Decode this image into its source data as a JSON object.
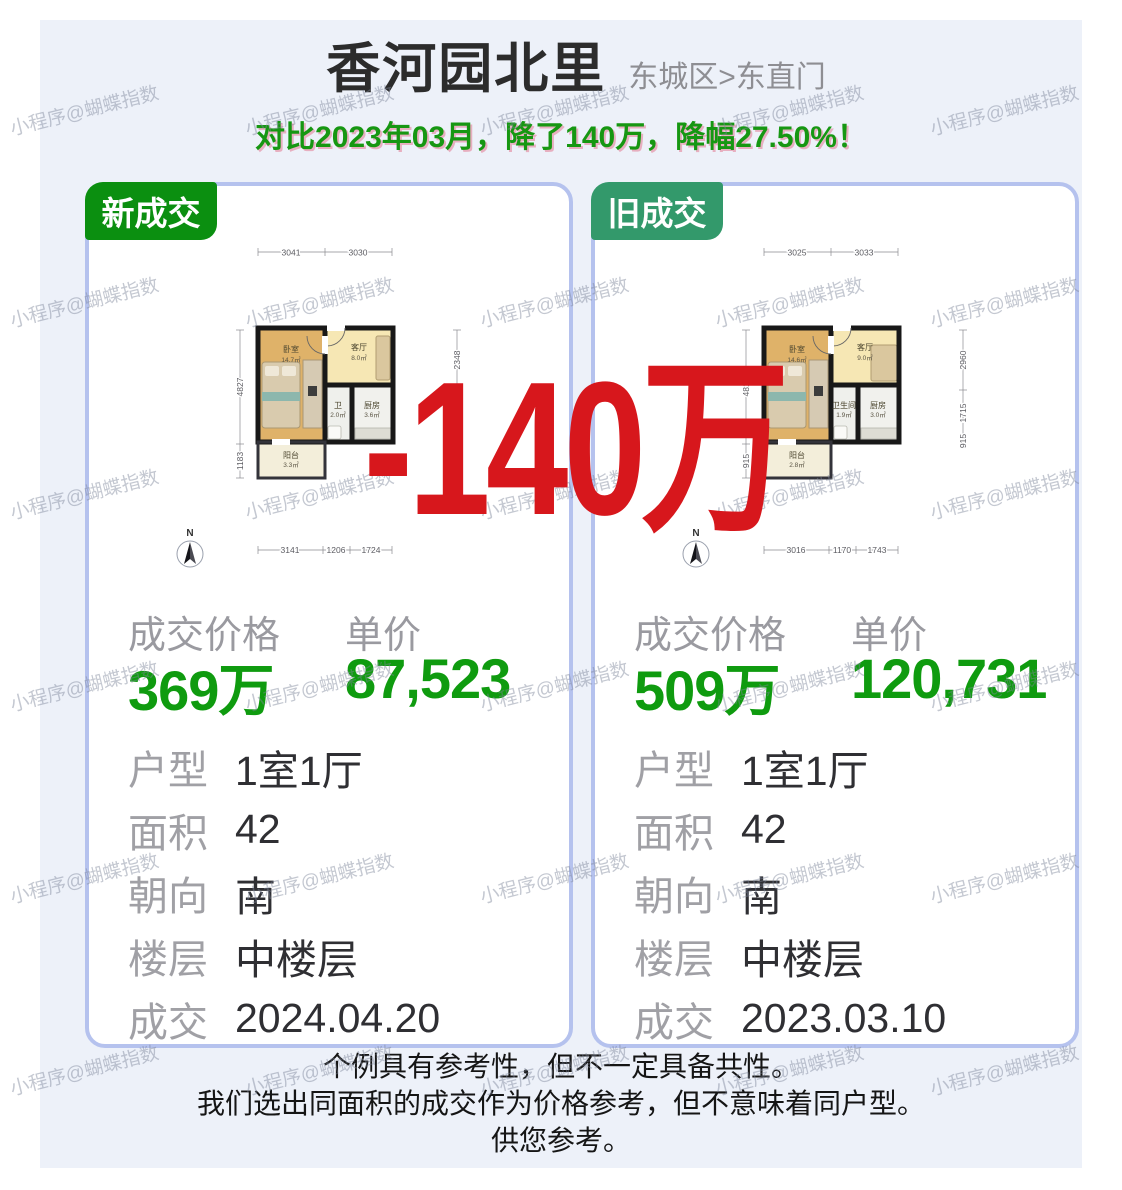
{
  "page": {
    "title": "香河园北里",
    "subtitle": "东城区>东直门",
    "banner": "对比2023年03月，降了140万，降幅27.50%！",
    "drop_text": "-140万",
    "watermark": "小程序@蝴蝶指数",
    "footer_lines": [
      "个例具有参考性，但不一定具备共性。",
      "我们选出同面积的成交作为价格参考，但不意味着同户型。",
      "供您参考。"
    ]
  },
  "colors": {
    "panel_bg": "#edf1f9",
    "card_border": "#b5c2ee",
    "badge_new_green": "#0b8f10",
    "badge_old_green": "#33996b",
    "price_green": "#0f9b0f",
    "banner_green": "#169712",
    "drop_red": "#d7171c"
  },
  "cards": [
    {
      "badge": "新成交",
      "badge_color": "#0b8f10",
      "price_label": "成交价格",
      "unit_label": "单价",
      "price": "369万",
      "unit_price": "87,523",
      "details": [
        {
          "label": "户型",
          "value": "1室1厅"
        },
        {
          "label": "面积",
          "value": "42"
        },
        {
          "label": "朝向",
          "value": "南"
        },
        {
          "label": "楼层",
          "value": "中楼层"
        },
        {
          "label": "成交",
          "value": "2024.04.20"
        }
      ],
      "floorplan": {
        "dims_top": [
          "3041",
          "3030"
        ],
        "dims_left": [
          "4827",
          "1183"
        ],
        "dims_right": [
          "2348",
          "1784",
          "106"
        ],
        "dims_bottom": [
          "3141",
          "1206",
          "1724"
        ],
        "rooms": [
          {
            "name": "卧室",
            "area": "14.7㎡"
          },
          {
            "name": "客厅",
            "area": "8.0㎡"
          },
          {
            "name": "卫",
            "area": "2.0㎡"
          },
          {
            "name": "厨房",
            "area": "3.6㎡"
          },
          {
            "name": "阳台",
            "area": "3.3㎡"
          }
        ],
        "compass": "N"
      }
    },
    {
      "badge": "旧成交",
      "badge_color": "#33996b",
      "price_label": "成交价格",
      "unit_label": "单价",
      "price": "509万",
      "unit_price": "120,731",
      "details": [
        {
          "label": "户型",
          "value": "1室1厅"
        },
        {
          "label": "面积",
          "value": "42"
        },
        {
          "label": "朝向",
          "value": "南"
        },
        {
          "label": "楼层",
          "value": "中楼层"
        },
        {
          "label": "成交",
          "value": "2023.03.10"
        }
      ],
      "floorplan": {
        "dims_top": [
          "3025",
          "3033"
        ],
        "dims_left": [
          "4815",
          "915"
        ],
        "dims_right": [
          "2960",
          "1715",
          "915"
        ],
        "dims_bottom": [
          "3016",
          "1170",
          "1743"
        ],
        "rooms": [
          {
            "name": "卧室",
            "area": "14.6㎡"
          },
          {
            "name": "客厅",
            "area": "9.0㎡"
          },
          {
            "name": "卫生间",
            "area": "1.9㎡"
          },
          {
            "name": "厨房",
            "area": "3.0㎡"
          },
          {
            "name": "阳台",
            "area": "2.8㎡"
          }
        ],
        "compass": "N"
      }
    }
  ]
}
